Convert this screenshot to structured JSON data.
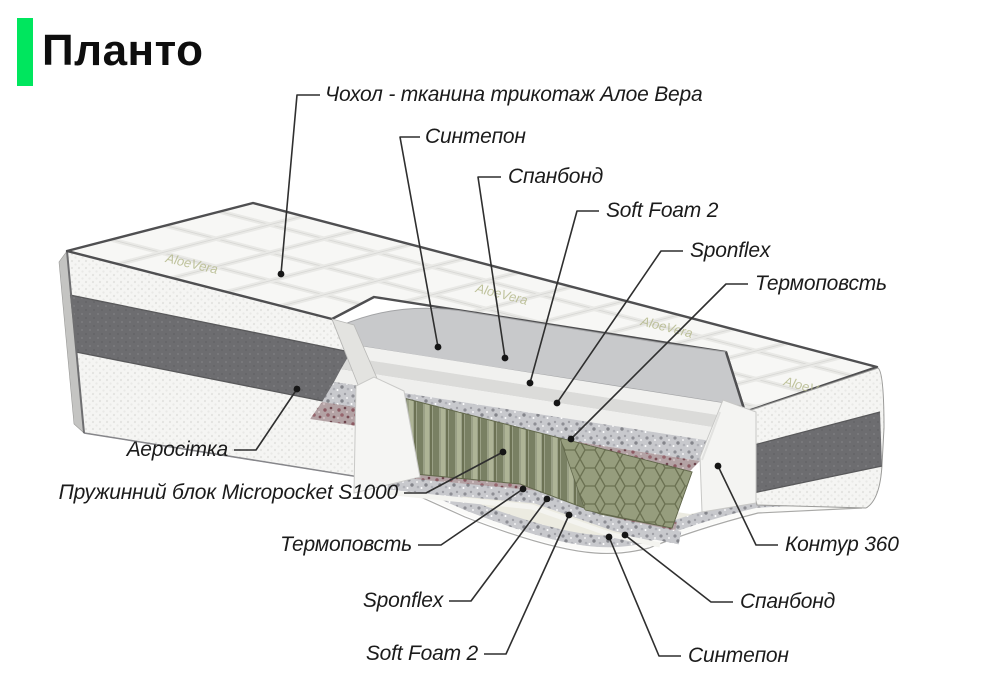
{
  "title": {
    "text": "Планто",
    "accent_color": "#00e65e"
  },
  "fabric_print": "AloeVera",
  "colors": {
    "background": "#ffffff",
    "leader_line": "#2f2f2f",
    "leader_dot": "#161616",
    "piping": "#4f4f51",
    "dark_band": "#6d6d70",
    "springs": "#9aa086",
    "contour_foam": "#f4f4f2",
    "termofelt_speckle": "#b3a2a4",
    "spanbond_speckle": "#c8c9cd"
  },
  "diagram": {
    "type": "mattress-layers-cutaway",
    "product": "Планто",
    "structure": {
      "cover": "Чохол - тканина трикотаж Алое Вера",
      "layers_top_to_bottom": [
        "Чохол - тканина трикотаж Алое Вера",
        "Синтепон",
        "Спанбонд",
        "Soft Foam 2",
        "Sponflex",
        "Термоповсть",
        "Пружинний блок Micropocket S1000",
        "Термоповсть",
        "Sponflex",
        "Soft Foam 2",
        "Спанбонд",
        "Синтепон"
      ],
      "side_layers": [
        "Аеросітка",
        "Контур 360"
      ]
    },
    "callouts": [
      {
        "id": "cover",
        "label": "Чохол - тканина трикотаж Алое Вера",
        "align": "left",
        "tx": 325,
        "ty": 95,
        "points": "320,95 297,95 281,274"
      },
      {
        "id": "sintepon-top",
        "label": "Синтепон",
        "align": "left",
        "tx": 425,
        "ty": 137,
        "points": "420,137 400,137 438,347"
      },
      {
        "id": "spanbond-top",
        "label": "Спанбонд",
        "align": "left",
        "tx": 508,
        "ty": 177,
        "points": "501,177 478,177 505,358"
      },
      {
        "id": "soft-foam-top",
        "label": "Soft Foam 2",
        "align": "left",
        "tx": 606,
        "ty": 211,
        "points": "599,211 577,211 530,383"
      },
      {
        "id": "sponflex-top",
        "label": "Sponflex",
        "align": "left",
        "tx": 690,
        "ty": 251,
        "points": "683,251 661,251 557,403"
      },
      {
        "id": "termofelt-top",
        "label": "Термоповсть",
        "align": "left",
        "tx": 755,
        "ty": 284,
        "points": "748,284 726,284 571,439"
      },
      {
        "id": "aerositka",
        "label": "Аеросітка",
        "align": "right",
        "tx": 228,
        "ty": 450,
        "points": "234,450 256,450 297,389"
      },
      {
        "id": "spring-block",
        "label": "Пружинний блок Micropocket S1000",
        "align": "right",
        "tx": 398,
        "ty": 493,
        "points": "404,493 426,493 503,452"
      },
      {
        "id": "termofelt-bottom",
        "label": "Термоповсть",
        "align": "right",
        "tx": 412,
        "ty": 545,
        "points": "418,545 441,545 523,489"
      },
      {
        "id": "sponflex-bottom",
        "label": "Sponflex",
        "align": "right",
        "tx": 443,
        "ty": 601,
        "points": "449,601 471,601 547,499"
      },
      {
        "id": "soft-foam-bottom",
        "label": "Soft Foam 2",
        "align": "right",
        "tx": 478,
        "ty": 654,
        "points": "484,654 506,654 569,515"
      },
      {
        "id": "kontur-360",
        "label": "Контур 360",
        "align": "left",
        "tx": 785,
        "ty": 545,
        "points": "778,545 756,545 718,466"
      },
      {
        "id": "spanbond-bottom",
        "label": "Спанбонд",
        "align": "left",
        "tx": 740,
        "ty": 602,
        "points": "733,602 711,602 625,535"
      },
      {
        "id": "sintepon-bottom",
        "label": "Синтепон",
        "align": "left",
        "tx": 688,
        "ty": 656,
        "points": "681,656 659,656 609,537"
      }
    ]
  }
}
